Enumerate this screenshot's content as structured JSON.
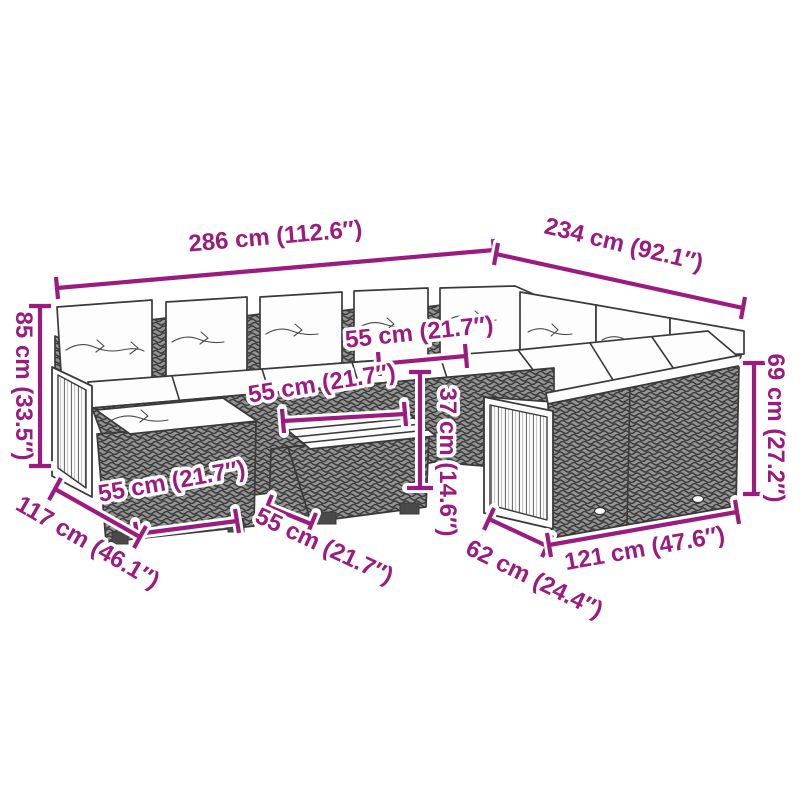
{
  "diagram": {
    "background_color": "#ffffff",
    "accent_color": "#9b1b7e",
    "line_color": "#3a3a3a",
    "illustration": "outdoor-rattan-corner-sofa-set-line-drawing",
    "dimensions": [
      {
        "id": "overall-width-left",
        "label": "286 cm (112.6″)"
      },
      {
        "id": "overall-width-right",
        "label": "234 cm (92.1″)"
      },
      {
        "id": "overall-height",
        "label": "85 cm (33.5″)"
      },
      {
        "id": "back-height-right",
        "label": "69 cm (27.2″)"
      },
      {
        "id": "seat-width",
        "label": "55 cm (21.7″)"
      },
      {
        "id": "table-top-width",
        "label": "55 cm (21.7″)"
      },
      {
        "id": "table-height",
        "label": "37 cm (14.6″)"
      },
      {
        "id": "footstool-width",
        "label": "55 cm (21.7″)"
      },
      {
        "id": "depth-left",
        "label": "117 cm (46.1″)"
      },
      {
        "id": "table-depth",
        "label": "55 cm (21.7″)"
      },
      {
        "id": "right-module-depth",
        "label": "62 cm (24.4″)"
      },
      {
        "id": "right-module-width",
        "label": "121 cm (47.6″)"
      }
    ]
  }
}
